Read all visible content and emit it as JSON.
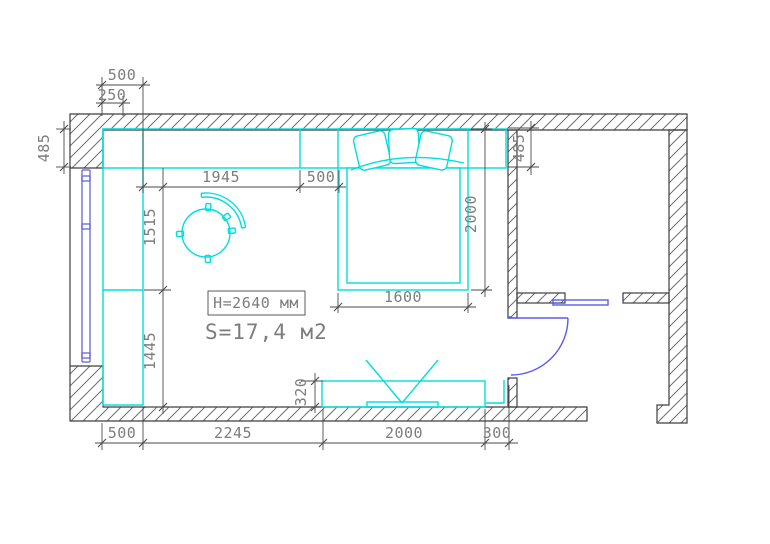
{
  "drawing": {
    "type": "bedroom floor plan",
    "labels": {
      "ceiling_height": "H=2640 мм",
      "area": "S=17,4 м2"
    },
    "dimensions_mm": {
      "top_500": "500",
      "top_250": "250",
      "left_485": "485",
      "width_1945": "1945",
      "width_500": "500",
      "height_1515": "1515",
      "height_1445": "1445",
      "bed_2000": "2000",
      "right_485": "485",
      "bed_1600": "1600",
      "tv_depth_320": "320",
      "bottom_500": "500",
      "bottom_2245": "2245",
      "bottom_2000": "2000",
      "bottom_300": "300"
    },
    "colors": {
      "furniture_cyan": "#00dede",
      "door_blue": "#5a5af0",
      "window_blue": "#6565d8",
      "wall_line": "#3e3e3e",
      "hatch_line": "#6e6e6e",
      "dimension_line": "#4a4a4a",
      "dimension_text": "#7d7d7d",
      "background": "#ffffff"
    }
  }
}
